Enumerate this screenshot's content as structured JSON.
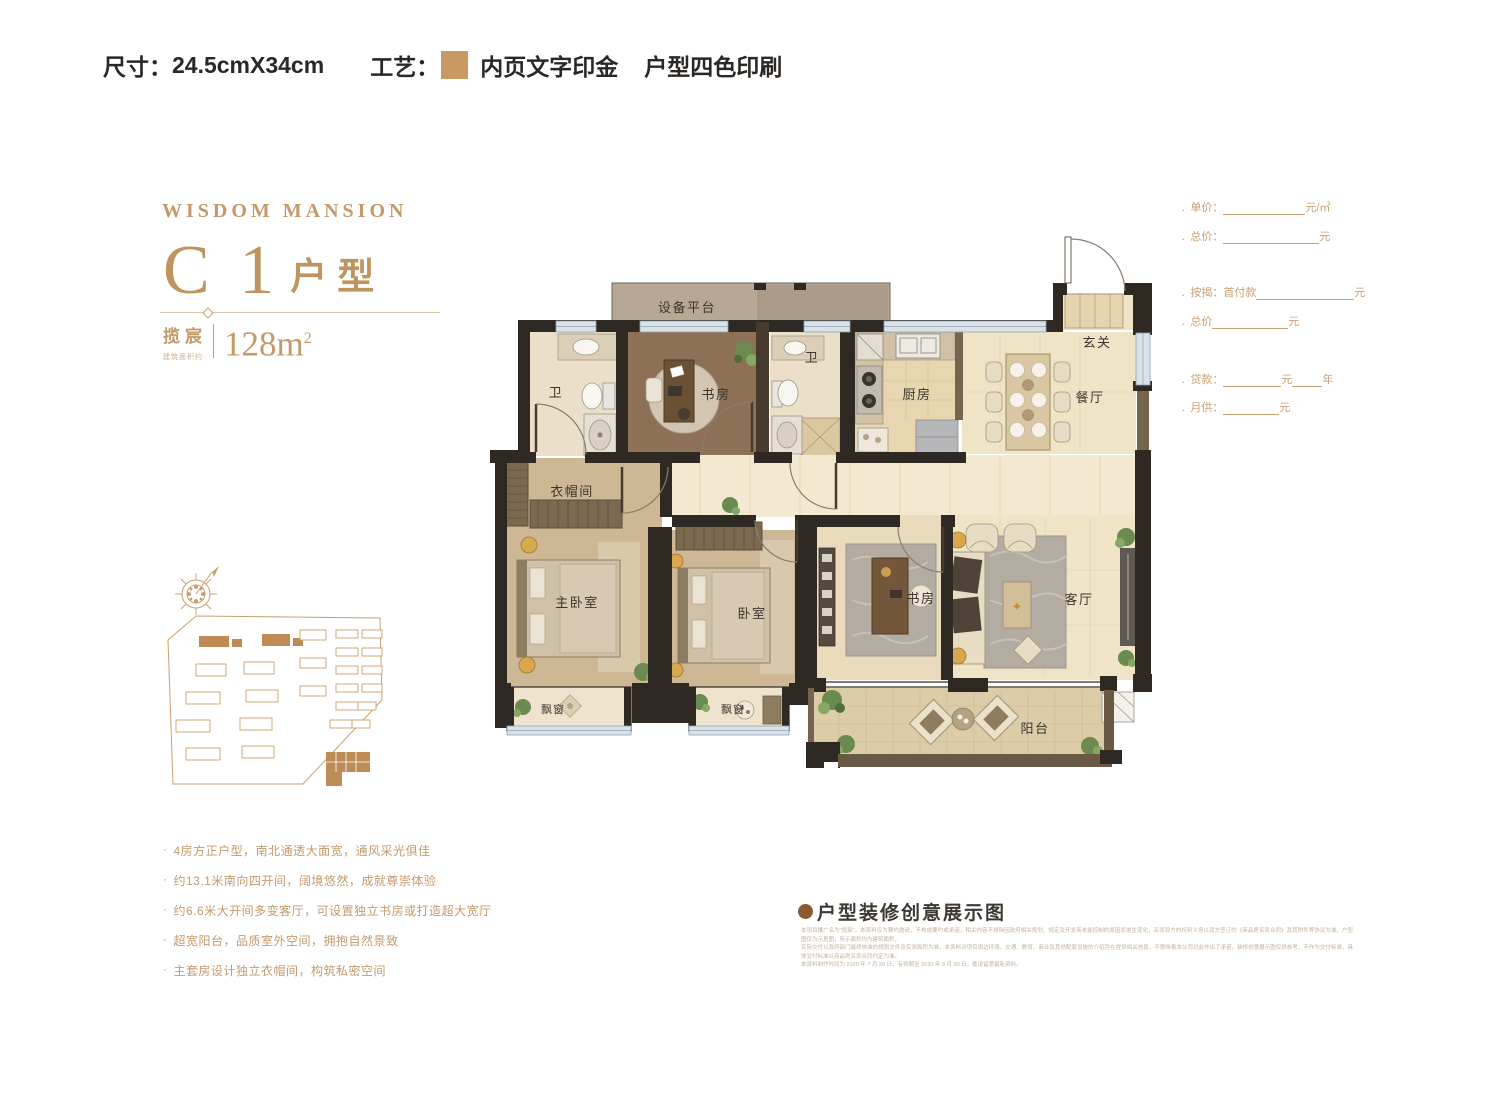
{
  "header": {
    "size_label": "尺寸：",
    "size_value": "24.5cmX34cm",
    "craft_label": "工艺：",
    "craft_swatch_color": "#c89a62",
    "craft_text_1": "内页文字印金",
    "craft_text_2": "户型四色印刷"
  },
  "brand": {
    "logo": "WISDOM MANSION",
    "unit_code": "C 1",
    "unit_suffix": "户型",
    "project_name": "揽宸",
    "area_note": "建筑面积约",
    "area_value": "128m",
    "area_sup": "2"
  },
  "pricing": {
    "rows": [
      {
        "label": "单价：",
        "suffix": "元/㎡"
      },
      {
        "label": "总价：",
        "suffix": "元"
      },
      {
        "label": "按揭：首付款",
        "suffix": "元"
      },
      {
        "label": "总价",
        "suffix": "元"
      },
      {
        "label": "贷款：",
        "suffix": "元",
        "suffix2": "年"
      },
      {
        "label": "月供：",
        "suffix": "元"
      }
    ]
  },
  "features": [
    "4房方正户型，南北通透大面宽，通风采光俱佳",
    "约13.1米南向四开间，阔境悠然，成就尊崇体验",
    "约6.6米大开间多变客厅，可设置独立书房或打造超大宽厅",
    "超宽阳台，品质室外空间，拥抱自然景致",
    "主套房设计独立衣帽间，构筑私密空间"
  ],
  "floorplan": {
    "rooms": [
      "设备平台",
      "卫",
      "书房",
      "卫",
      "厨房",
      "玄关",
      "餐厅",
      "衣帽间",
      "主卧室",
      "卧室",
      "书房",
      "客厅",
      "飘窗",
      "飘窗",
      "阳台"
    ]
  },
  "showcase": {
    "title": "户型装修创意展示图",
    "disclaimer_lines": [
      "本项目推广名为“揽宸”，本资料仅为要约邀请，不构成要约或承诺，相关内容不排除因政府相关规划、规定及开发商未能控制的原因而发生变化，买卖双方的权利义务以双方签订的《商品房买卖合同》及其附件等协议为准。户型图仅为示意图，所示面积均为建筑面积，",
      "实际交付以政府部门最终核准的规划文件及实测面积为准。本资料对项目周边环境、交通、教育、商业及其他配套设施的介绍旨在提供相关信息，不意味着本公司对此作出了承诺。装修创意展示图仅供参考，不作为交付标准，具体交付标准以商品房买卖合同约定为准。",
      "本资料制作时间为 2020 年 7 月 20 日，有效期至 2020 年 9 月 30 日，敬请留意最新资料。"
    ]
  },
  "colors": {
    "gold": "#c49a6b",
    "wall_dark": "#2f2923",
    "wall_brown": "#75654f",
    "floor_light": "#f0e4c7",
    "floor_tan": "#cdb795",
    "floor_wood": "#8d7055",
    "window_blue": "#d9e2e9"
  }
}
